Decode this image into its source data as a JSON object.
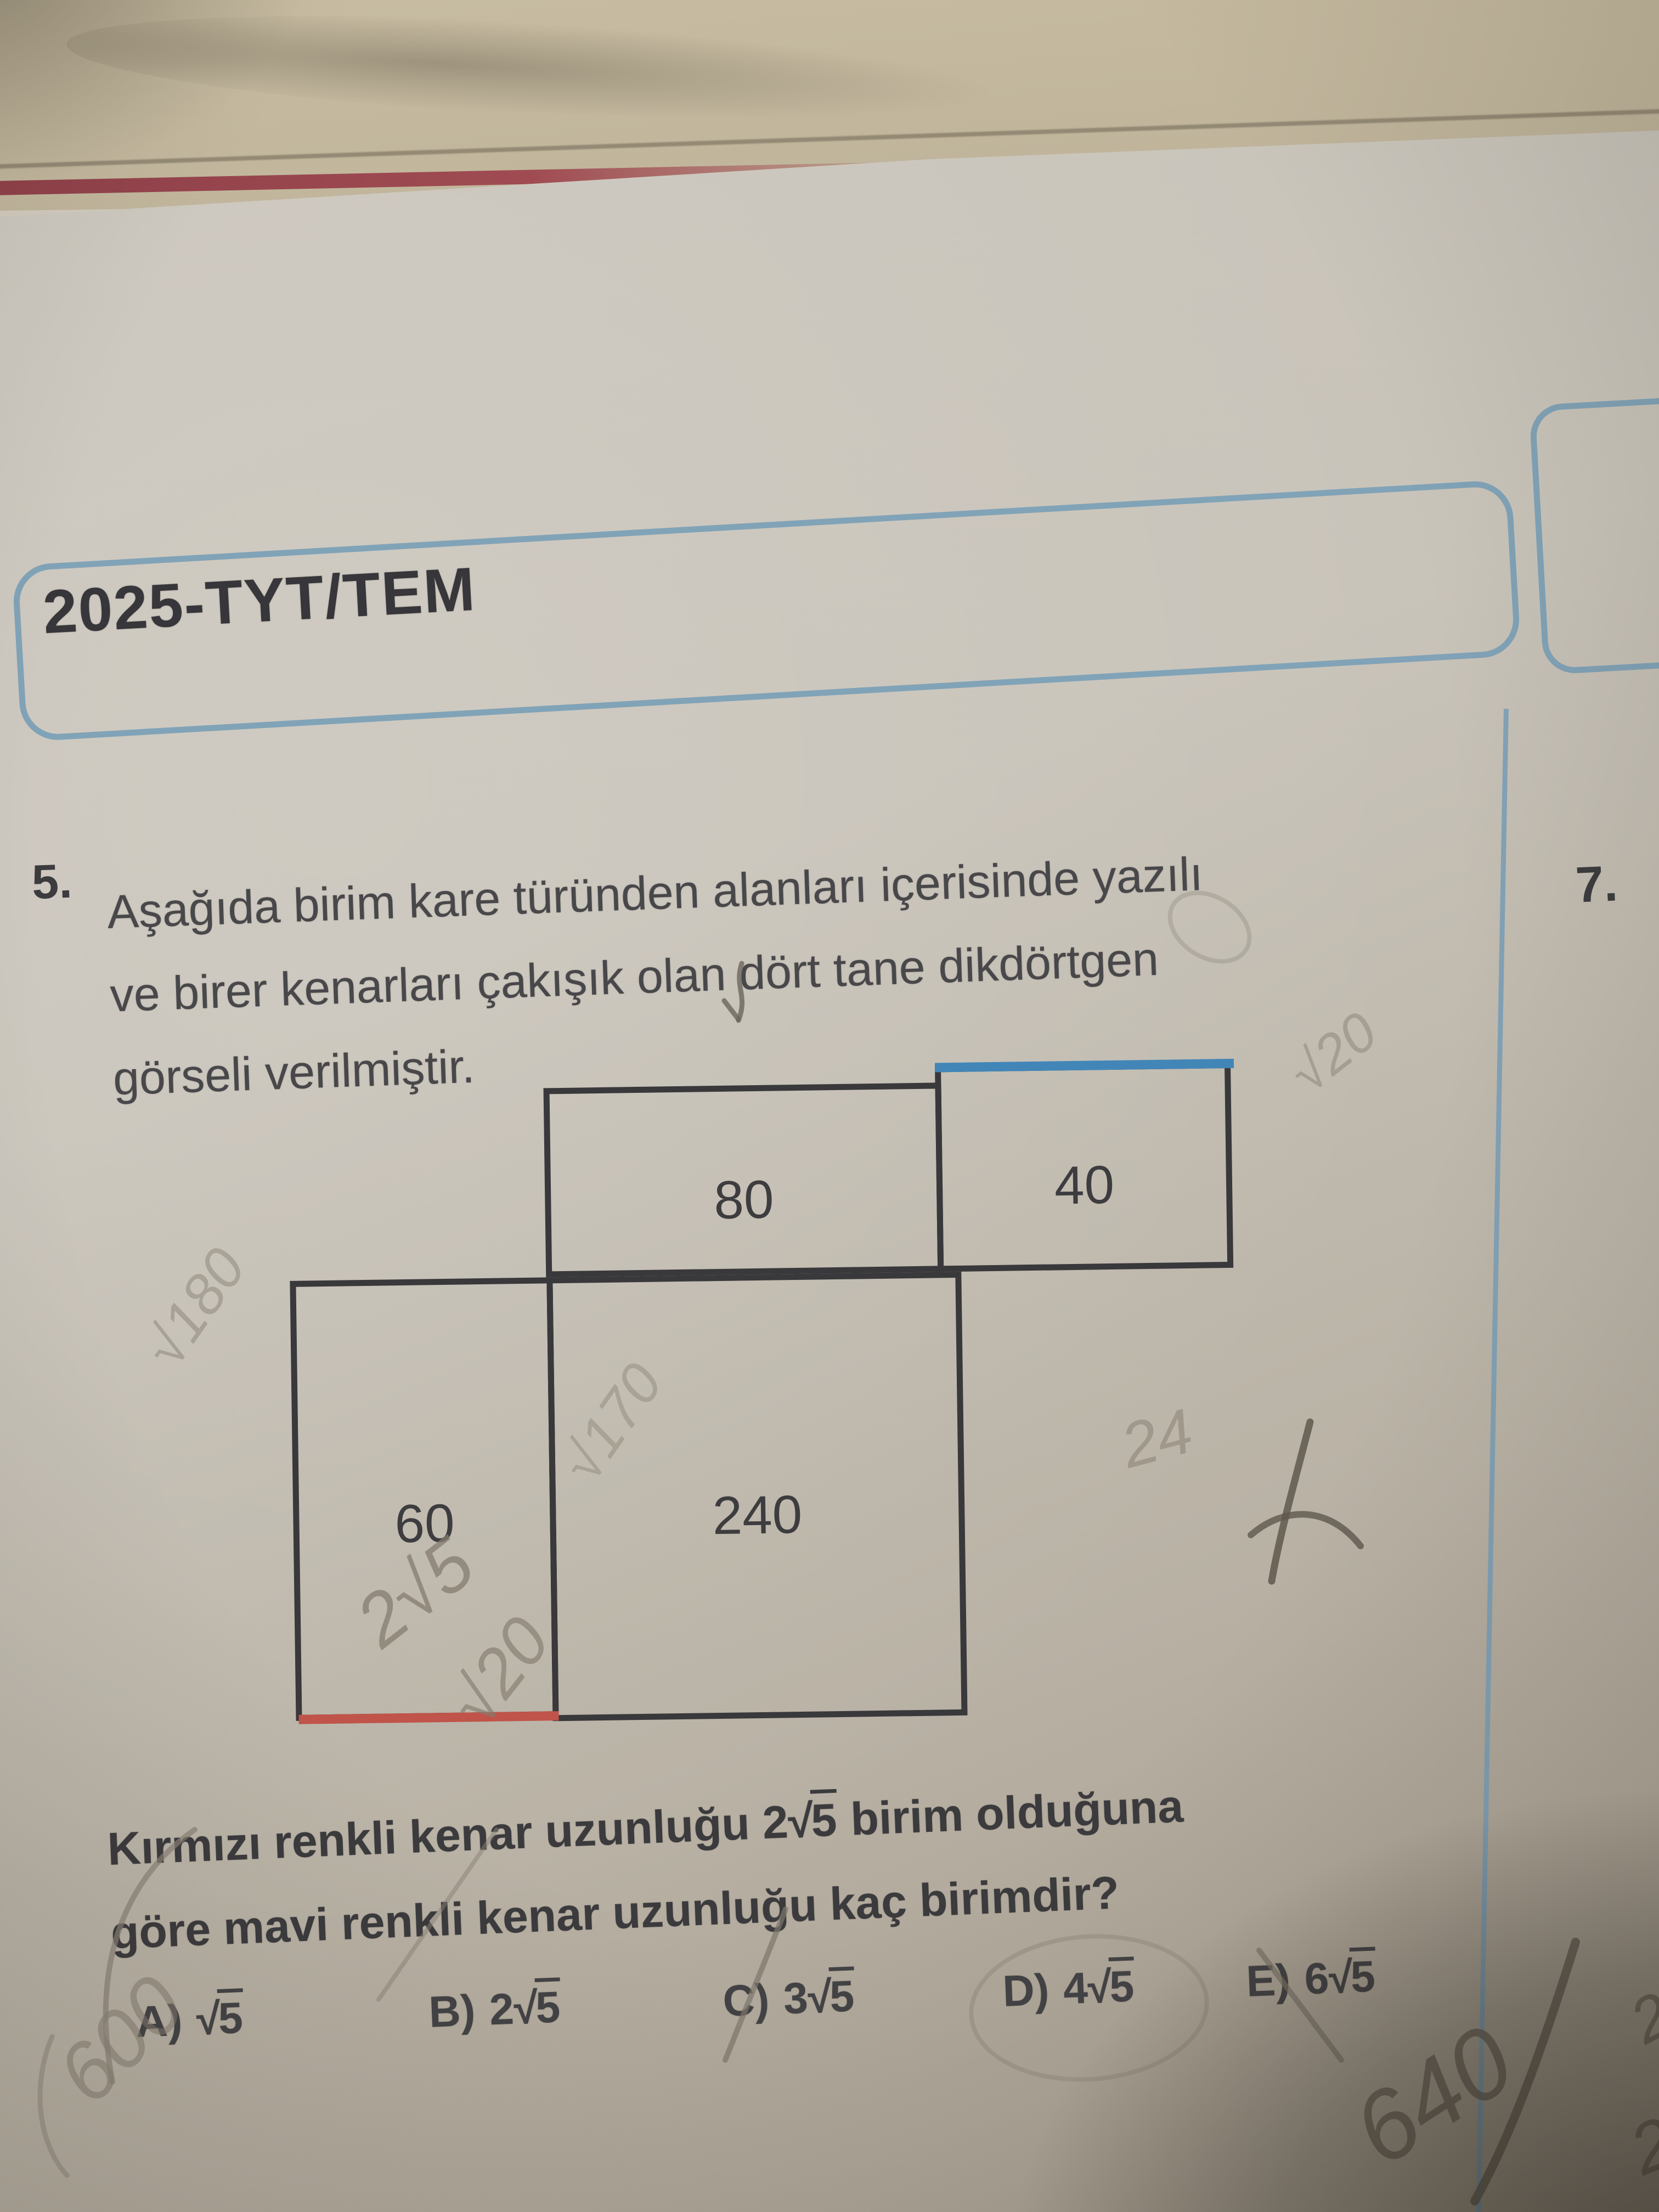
{
  "header": {
    "title": "2025-TYT/TEM"
  },
  "right_column": {
    "question_number": "7."
  },
  "question": {
    "number": "5.",
    "lines": [
      "Aşağıda birim kare türünden alanları içerisinde yazılı",
      "ve birer kenarları çakışık olan dört tane dikdörtgen",
      "görseli verilmiştir."
    ],
    "bold_prompt": {
      "prefix": "Kırmızı renkli kenar uzunluğu ",
      "coef": "2",
      "radical_symbol": "√",
      "radicand": "5",
      "suffix": " birim olduğuna",
      "line2": "göre mavi renkli kenar uzunluğu kaç birimdir?"
    },
    "options": [
      {
        "letter": "A)",
        "coef": "",
        "radicand": "5"
      },
      {
        "letter": "B)",
        "coef": "2",
        "radicand": "5"
      },
      {
        "letter": "C)",
        "coef": "3",
        "radicand": "5"
      },
      {
        "letter": "D)",
        "coef": "4",
        "radicand": "5"
      },
      {
        "letter": "E)",
        "coef": "6",
        "radicand": "5"
      }
    ]
  },
  "diagram": {
    "areas": {
      "top_left": "80",
      "top_right": "40",
      "bottom_left": "60",
      "bottom_center": "240"
    },
    "blue_edge_color": "#4286b8",
    "red_edge_color": "#c0544a"
  },
  "handwriting": {
    "over_red_edge": "2√5",
    "below_red_edge": "√20",
    "right_of_top_rect": "√20",
    "left_margin": "√180",
    "inside_240": "√170",
    "right_of_240": "24",
    "bottom_left": "600",
    "bottom_right_big": "640",
    "bottom_right_upper": "22",
    "bottom_right_lower": "25"
  },
  "colors": {
    "paper": "#c7c2b8",
    "ink": "#413f42",
    "frame_blue": "#7b9fb6",
    "edge_blue": "#4286b8",
    "edge_red": "#c0544a",
    "pencil": "#857d70"
  }
}
